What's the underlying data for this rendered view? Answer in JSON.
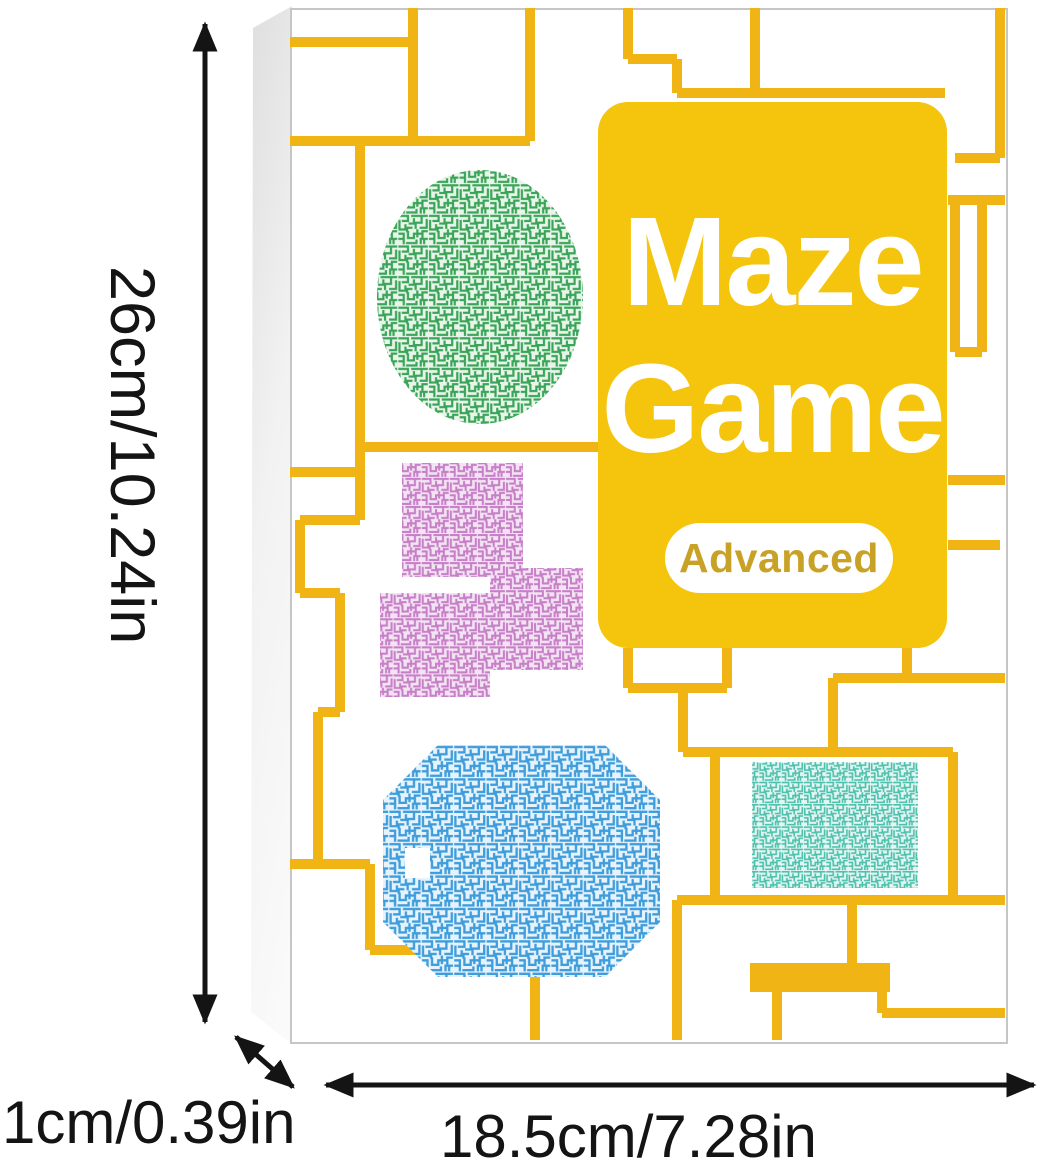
{
  "product": {
    "title_line1": "Maze",
    "title_line2": "Game",
    "badge_label": "Advanced"
  },
  "dimensions": {
    "height_label": "26cm/10.24in",
    "depth_label": "1cm/0.39in",
    "width_label": "18.5cm/7.28in"
  },
  "colors": {
    "circuit_yellow": "#F0B414",
    "card_yellow": "#F5C40C",
    "badge_text_gold": "#C8A227",
    "maze_green": "#3AA558",
    "maze_purple": "#C77FC7",
    "maze_blue": "#3F9DDB",
    "maze_teal": "#4EC0AD",
    "dimension_black": "#141414",
    "box_edge_gray": "#C6C6C6"
  }
}
